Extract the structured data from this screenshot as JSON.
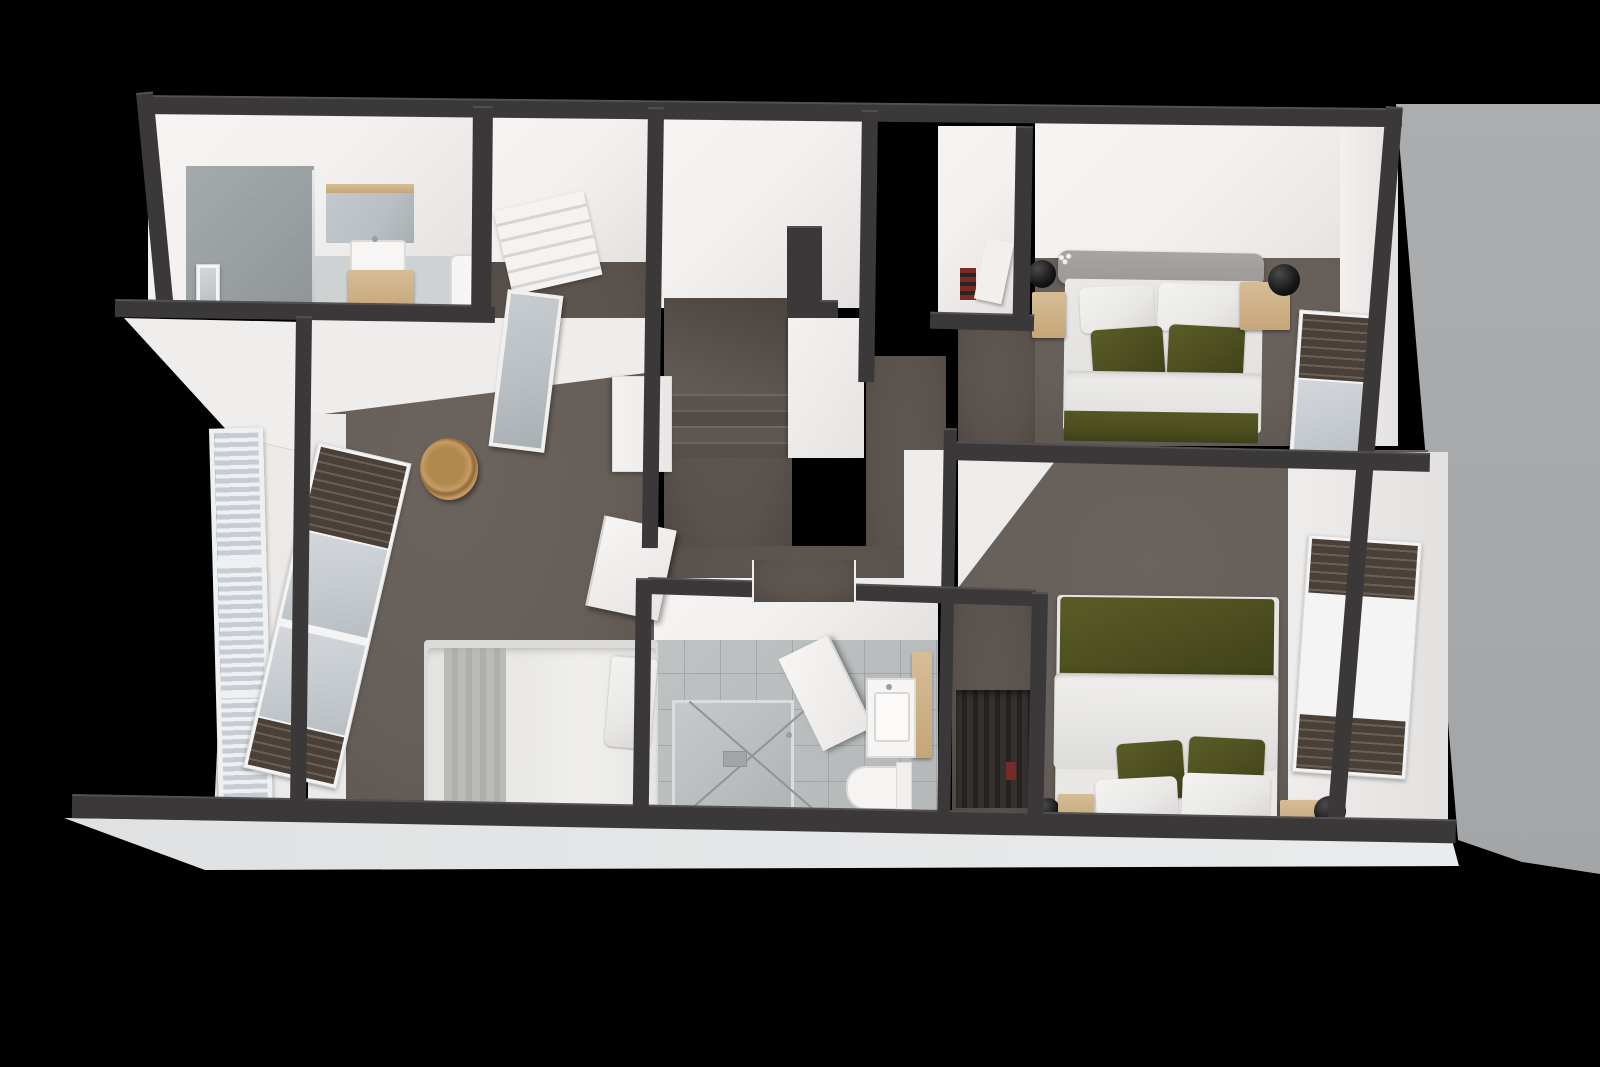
{
  "scene": {
    "title": "3D cutaway floor plan render of an upper storey, viewed from above on a black background",
    "view": "top-down dollhouse render",
    "visible_text": "none"
  },
  "palette": {
    "background": "#000000",
    "wall": "#3b3839",
    "wallEdge": "#858283",
    "whiteWall": "#f3f1ef",
    "whiteShade": "#e3e1df",
    "carpet": "#665e58",
    "carpetDark": "#4f4843",
    "carpetHall": "#5a524c",
    "tile": "#b5b8b9",
    "tileDark": "#9aa0a2",
    "glass": "#c7ccd1",
    "blindDark": "#4a4038",
    "wood": "#d7bd96",
    "woodDark": "#c5a678",
    "green": "#4c4e1f",
    "greenDark": "#3e4019",
    "bedWhite": "#e9e8e6",
    "bedShade": "#d8d6d4",
    "headboard": "#9c9895",
    "lamp": "#161617",
    "grayExterior": "#a7a9ab",
    "slab": "#e9ebec",
    "shutter": "#ccd2d7",
    "mirror": "#b9bfc3",
    "metal": "#9b9fa3",
    "accentRed": "#7a2a24"
  },
  "rooms": [
    {
      "name": "Ensuite bathroom (top left)",
      "floor": "tile",
      "furniture": [
        "walk-in shower with grey tiled wall",
        "glass shower screen",
        "ceiling shower rail",
        "corner window",
        "mirror cabinet with oak trim",
        "white basin",
        "oak vanity cabinet",
        "toilet"
      ]
    },
    {
      "name": "Dressing room / landing closet",
      "floor": "carpet",
      "furniture": [
        "white open shelf unit",
        "leaning floor mirror",
        "open white door"
      ]
    },
    {
      "name": "Stairwell",
      "floor": "carpet",
      "furniture": [
        "carpeted staircase with four visible treads",
        "dark stair-opening wall stub",
        "white guard wall"
      ]
    },
    {
      "name": "Hallway",
      "floor": "carpet",
      "furniture": []
    },
    {
      "name": "Bedroom 1 (top right)",
      "floor": "carpet",
      "furniture": [
        "double bed with grey headboard",
        "two white pillows",
        "two olive green pillows",
        "white duvet",
        "olive green throw",
        "two oak nightstands",
        "two black sphere lamps",
        "white flowers",
        "window with dark venetian blind",
        "closet nook with stored items"
      ]
    },
    {
      "name": "Bedroom 2 (bottom right)",
      "floor": "carpet",
      "furniture": [
        "double bed with olive green blanket",
        "white duvet",
        "two olive green pillows",
        "two white pillows",
        "two oak nightstands",
        "two black sphere lamps",
        "tall window with dark venetian blinds",
        "closet with hanging clothes"
      ]
    },
    {
      "name": "Bedroom 3 (left)",
      "floor": "carpet",
      "furniture": [
        "double bed with white duvet and grey throw",
        "stacked white pillows",
        "white wardrobe",
        "wicker basket",
        "tall window with dark venetian blinds",
        "open white door"
      ]
    },
    {
      "name": "Family bathroom (bottom middle)",
      "floor": "tile",
      "furniture": [
        "walk-in shower with glass screen",
        "open white door",
        "oak vanity with white basin",
        "toilet",
        "doorway to hallway"
      ]
    },
    {
      "name": "Exterior",
      "floor": "none",
      "furniture": [
        "white louvre shutter window on lower facade",
        "white floor slab edge",
        "grey side elevation plane"
      ]
    }
  ]
}
